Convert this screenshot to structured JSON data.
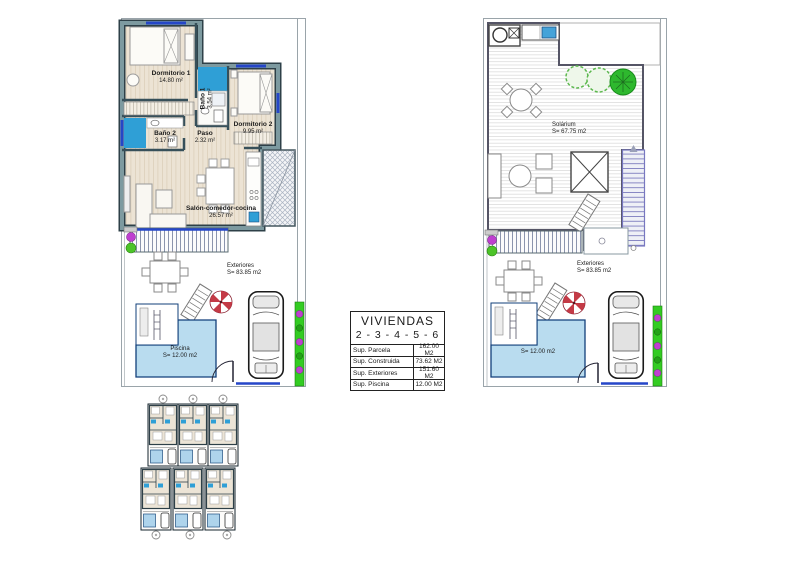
{
  "plan_ground": {
    "rooms": [
      {
        "name": "Dormitorio 1",
        "area": "14.80 m²"
      },
      {
        "name": "Baño 1",
        "area": "3.54 m²"
      },
      {
        "name": "Dormitorio 2",
        "area": "9.95 m²"
      },
      {
        "name": "Baño 2",
        "area": "3.17 m²"
      },
      {
        "name": "Paso",
        "area": "2.32 m²"
      },
      {
        "name": "Salón-comedor-cocina",
        "area": "26.57 m²"
      }
    ],
    "exteriores": {
      "name": "Exteriores",
      "area": "S= 83.85 m2"
    },
    "piscina": {
      "name": "Piscina",
      "area": "S= 12.00 m2"
    }
  },
  "plan_roof": {
    "solarium": {
      "name": "Solárium",
      "area": "S= 67.75 m2"
    },
    "exteriores": {
      "name": "Exteriores",
      "area": "S= 83.85 m2"
    },
    "piscina": {
      "area": "S= 12.00 m2"
    }
  },
  "summary_table": {
    "title": "VIVIENDAS",
    "subtitle": "2 - 3 - 4 - 5 - 6",
    "rows": [
      {
        "label": "Sup. Parcela",
        "value": "162.00 M2"
      },
      {
        "label": "Sup. Construida",
        "value": "73.62 M2"
      },
      {
        "label": "Sup. Exteriores",
        "value": "151.60 M2"
      },
      {
        "label": "Sup. Piscina",
        "value": "12.00 M2"
      }
    ]
  },
  "colors": {
    "wall_fill": "#7d9aa0",
    "wall_edge": "#2e4048",
    "bathroom_floor": "#2f9fd6",
    "pool_water": "#b9dcef",
    "pool_edge": "#123f7a",
    "window_blue": "#2546c8",
    "hedge_green": "#33cc22",
    "flower_magenta": "#bf3fd0",
    "tree_green": "#2eb82e",
    "deck_line": "#d8d8d8",
    "stair_violet": "#7878c0",
    "parasol_red": "#c43a46",
    "wood_floor": "#ece3d4"
  }
}
